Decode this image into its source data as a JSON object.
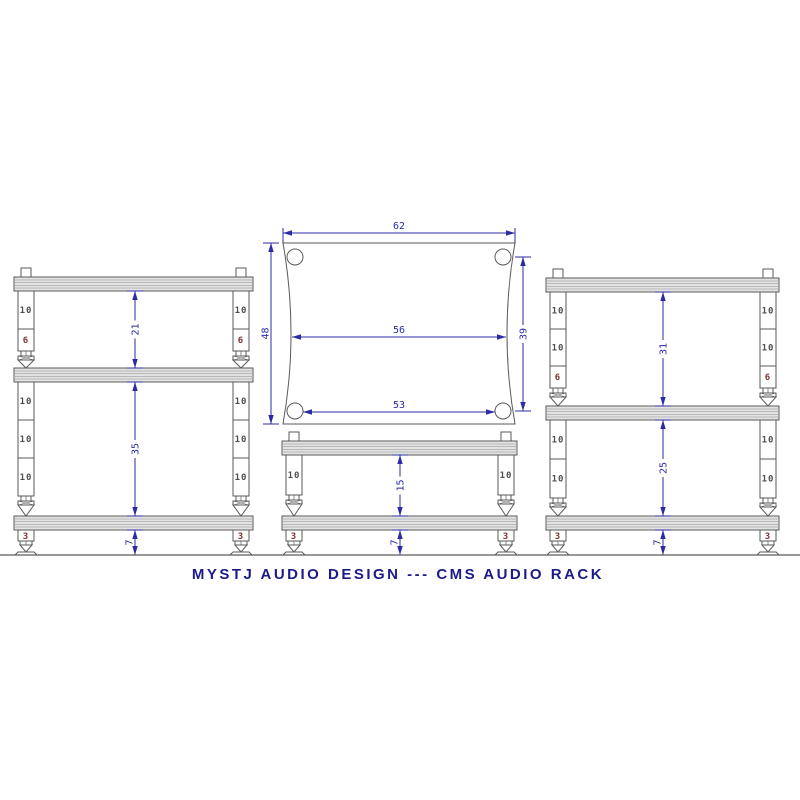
{
  "title": "MYSTJ AUDIO DESIGN --- CMS AUDIO RACK",
  "colors": {
    "dimension_blue": "#2b2ba4",
    "title_navy": "#1b1b8a",
    "outline_gray": "#5a5a5a",
    "segment_label_gray": "#4f4f4f",
    "segment_label_maroon": "#7a3434",
    "shelf_fill": "#e3e3e3",
    "background": "#ffffff"
  },
  "top_view": {
    "width_overall": "62",
    "width_waist": "56",
    "width_hole_span": "53",
    "depth_overall": "48",
    "depth_hole_span": "39"
  },
  "racks": {
    "left": {
      "upper_segments": [
        "10",
        "6"
      ],
      "lower_segments": [
        "10",
        "10",
        "10"
      ],
      "foot_label": "3",
      "gap_dims": [
        "21",
        "35"
      ],
      "foot_dim": "7"
    },
    "center_low": {
      "segments": [
        "10"
      ],
      "foot_label": "3",
      "gap_dims": [
        "15"
      ],
      "foot_dim": "7"
    },
    "right": {
      "upper_segments": [
        "10",
        "10",
        "6"
      ],
      "lower_segments": [
        "10",
        "10"
      ],
      "foot_label": "3",
      "gap_dims": [
        "31",
        "25"
      ],
      "foot_dim": "7"
    }
  }
}
